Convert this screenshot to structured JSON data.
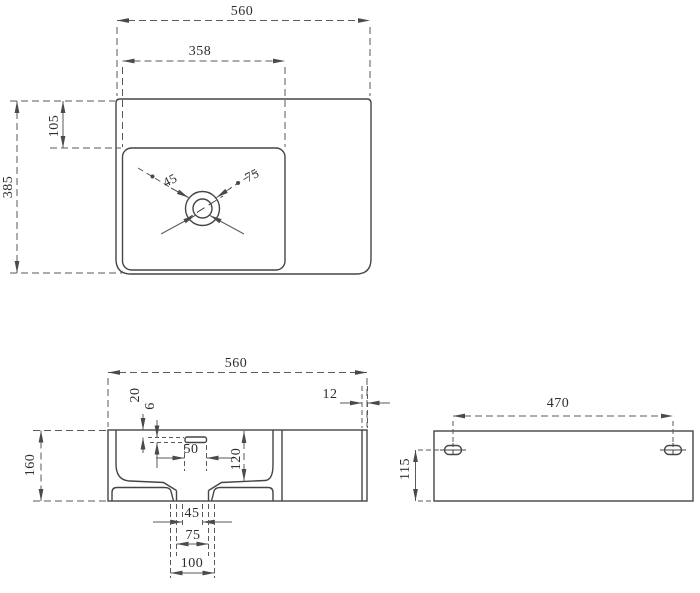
{
  "colors": {
    "background": "#ffffff",
    "outline": "#454545",
    "dimension_line": "#5a5a5a",
    "text": "#2e2e2e"
  },
  "views": {
    "top": {
      "dims": {
        "overall_width": "560",
        "basin_width": "358",
        "overall_depth": "385",
        "basin_top_offset": "105",
        "drain_hole_dia": "45",
        "drain_flange_dia": "75"
      }
    },
    "front": {
      "dims": {
        "overall_width": "560",
        "rim_thickness": "12",
        "overall_height": "160",
        "overflow_top_offset": "20",
        "overflow_slot_height": "6",
        "overflow_slot_width": "50",
        "basin_depth": "120",
        "drain_width": "45",
        "drain_stem_width": "75",
        "drain_base_width": "100"
      }
    },
    "back": {
      "dims": {
        "mount_hole_spacing": "470",
        "mount_hole_offset_bottom": "115"
      }
    }
  }
}
